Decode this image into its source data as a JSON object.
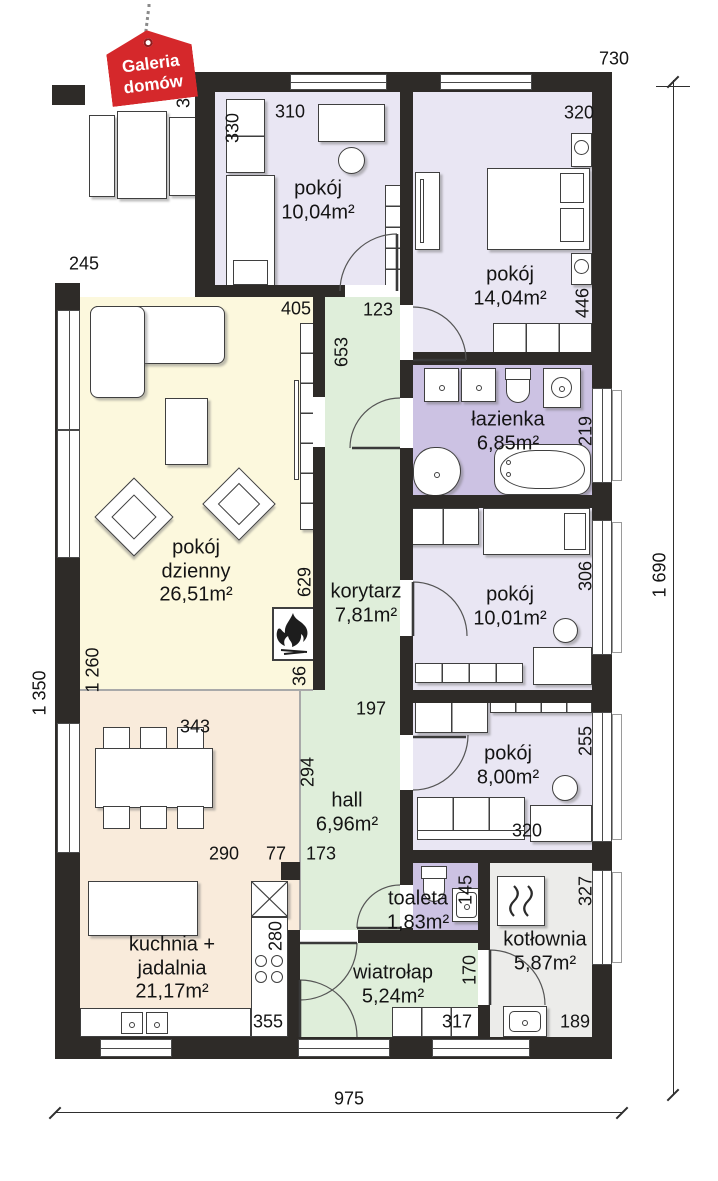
{
  "logo": {
    "line1": "Galeria",
    "line2": "domów"
  },
  "rooms": {
    "r1004": {
      "name": "pokój",
      "area": "10,04m²"
    },
    "r1404": {
      "name": "pokój",
      "area": "14,04m²"
    },
    "lazienka": {
      "name": "łazienka",
      "area": "6,85m²"
    },
    "korytarz": {
      "name": "korytarz",
      "area": "7,81m²"
    },
    "r1001": {
      "name": "pokój",
      "area": "10,01m²"
    },
    "dzienny": {
      "name": "pokój dzienny",
      "area": "26,51m²"
    },
    "r800": {
      "name": "pokój",
      "area": "8,00m²"
    },
    "hall": {
      "name": "hall",
      "area": "6,96m²"
    },
    "kuchnia": {
      "name": "kuchnia + jadalnia",
      "area": "21,17m²"
    },
    "toaleta": {
      "name": "toaleta",
      "area": "1,83m²"
    },
    "wiatrolap": {
      "name": "wiatrołap",
      "area": "5,24m²"
    },
    "kotlownia": {
      "name": "kotłownia",
      "area": "5,87m²"
    }
  },
  "dims": {
    "top": "730",
    "terrace_depth": "340",
    "r1004_w": "310",
    "r1004_h": "330",
    "r1404_w": "320",
    "r1404_h": "446",
    "terrace_w": "245",
    "living_w": "405",
    "korytarz_w": "123",
    "korytarz_h": "653",
    "lazienka_h": "219",
    "r1001_h": "306",
    "living_h2": "629",
    "living_h": "1 260",
    "left_total": "1 350",
    "right_total": "1 690",
    "kitchen_w": "343",
    "hall_top_w": "197",
    "hall_h": "294",
    "r800_h": "255",
    "r800_w": "320",
    "kitchen_w2": "290",
    "seg_77": "77",
    "hall_w": "173",
    "toaleta_h": "145",
    "kotlownia_h": "327",
    "counter_h": "280",
    "wiatrolap_h": "170",
    "kitchen_bottom_w": "355",
    "wardrobe_w": "317",
    "kotlownia_w": "189",
    "bottom": "975",
    "wall_stub": "36"
  },
  "colors": {
    "wall": "#2e2b28",
    "bedroom": "#e9e6f3",
    "bathroom": "#ccc2e3",
    "living": "#fcf8dd",
    "kitchen": "#f9ebdb",
    "hall": "#dfeeda",
    "utility": "#ececea",
    "logo_red": "#d5282b"
  }
}
